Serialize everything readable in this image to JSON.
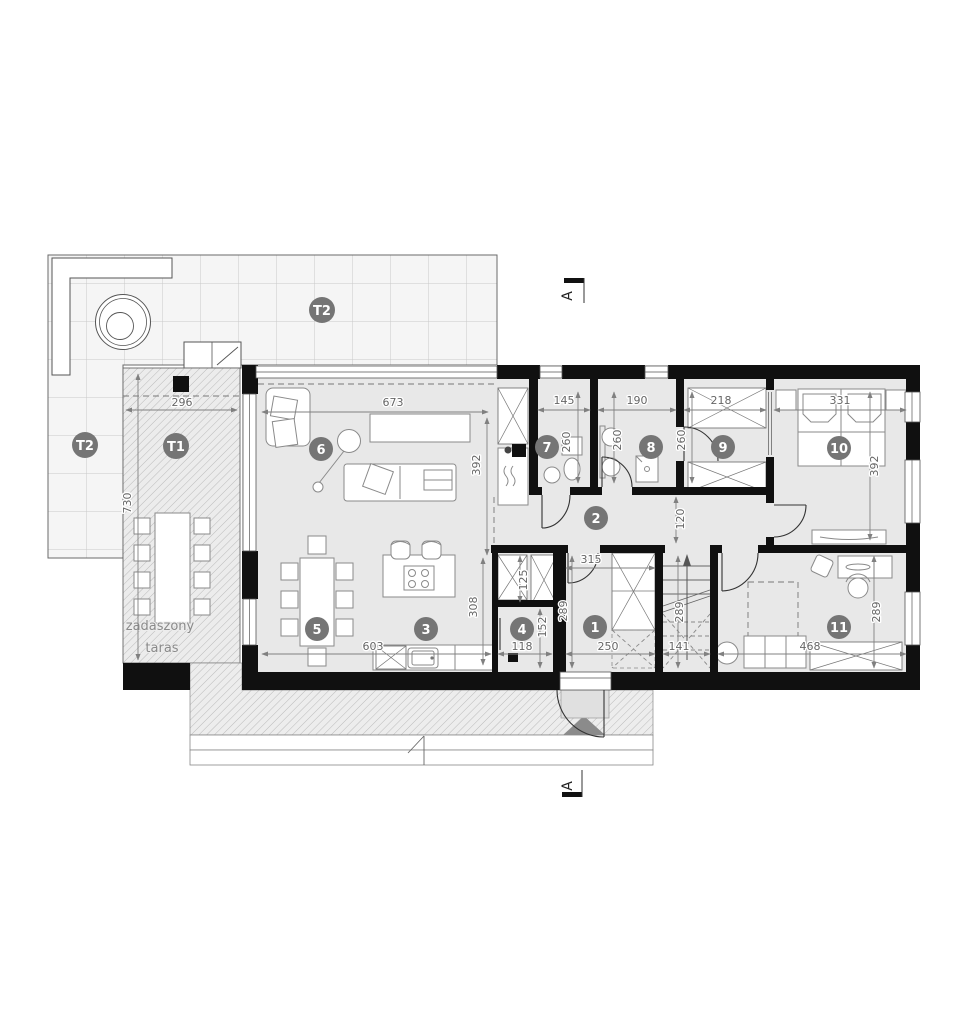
{
  "section_marker": {
    "label": "A"
  },
  "terraces": {
    "t2_label": "T2",
    "t1_label": "T1",
    "t1_caption_1": "zadaszony",
    "t1_caption_2": "taras"
  },
  "rooms": {
    "r1": "1",
    "r2": "2",
    "r3": "3",
    "r4": "4",
    "r5": "5",
    "r6": "6",
    "r7": "7",
    "r8": "8",
    "r9": "9",
    "r10": "10",
    "r11": "11"
  },
  "dims": {
    "t1_width": "296",
    "t1_depth": "730",
    "living_width": "673",
    "living_depth": "392",
    "wc_width": "145",
    "wc_depth": "260",
    "bath_width": "190",
    "bath_depth": "260",
    "wardrobe_width": "218",
    "wardrobe_depth": "260",
    "bedroom_width": "331",
    "bedroom_depth": "392",
    "hall_width": "315",
    "hall_depth": "289",
    "hall_width_lower": "250",
    "corridor_width": "120",
    "stairs_depth": "289",
    "stairs_width": "141",
    "office_width": "468",
    "office_depth": "289",
    "kitchen_width": "603",
    "kitchen_depth": "308",
    "pantry_width": "118",
    "pantry_depth": "152",
    "closet_depth": "125"
  }
}
